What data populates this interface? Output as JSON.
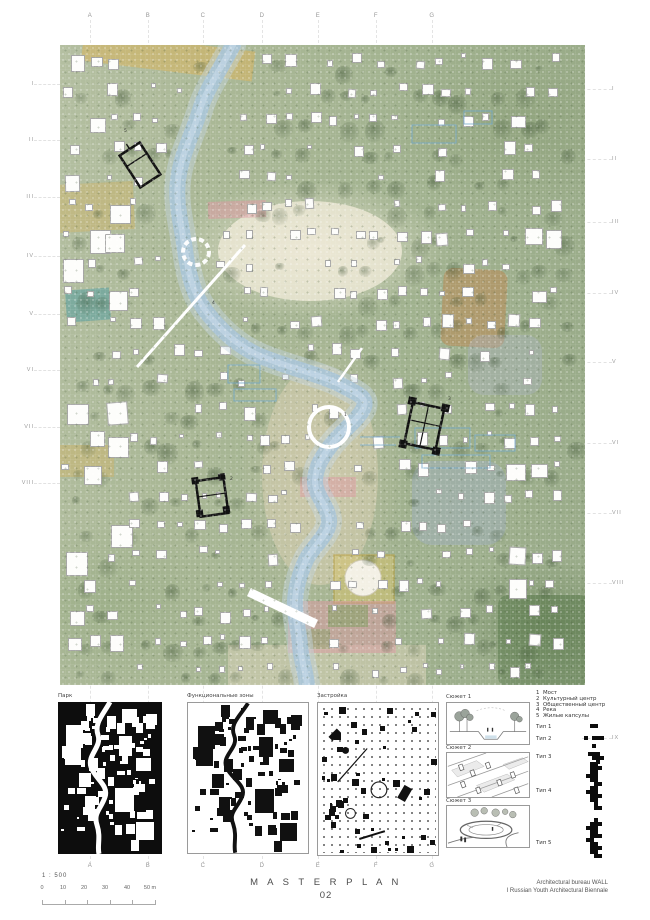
{
  "sheet": {
    "title": "M A S T E R P L A N",
    "number": "02",
    "scale_label": "1 : 500",
    "credit_line1": "Architectural bureau WALL",
    "credit_line2": "I Russian Youth Architectural Biennale"
  },
  "scalebar": {
    "ticks": [
      "0",
      "10",
      "20",
      "30",
      "40",
      "50 m"
    ],
    "xs": [
      42,
      63,
      84,
      105,
      127,
      150
    ]
  },
  "rulers": {
    "top_letters": [
      {
        "label": "A",
        "x": 90
      },
      {
        "label": "B",
        "x": 148
      },
      {
        "label": "C",
        "x": 203
      },
      {
        "label": "D",
        "x": 262
      },
      {
        "label": "E",
        "x": 318
      },
      {
        "label": "F",
        "x": 376
      },
      {
        "label": "G",
        "x": 432
      }
    ],
    "bottom_letters": [
      {
        "label": "A",
        "x": 90
      },
      {
        "label": "B",
        "x": 148
      },
      {
        "label": "C",
        "x": 203
      },
      {
        "label": "D",
        "x": 262
      },
      {
        "label": "E",
        "x": 318
      },
      {
        "label": "F",
        "x": 376
      },
      {
        "label": "G",
        "x": 432
      }
    ],
    "left_numerals": [
      {
        "label": "I",
        "y": 84
      },
      {
        "label": "II",
        "y": 140
      },
      {
        "label": "III",
        "y": 197
      },
      {
        "label": "IV",
        "y": 256
      },
      {
        "label": "V",
        "y": 314
      },
      {
        "label": "VI",
        "y": 370
      },
      {
        "label": "VII",
        "y": 427
      },
      {
        "label": "VIII",
        "y": 483
      }
    ],
    "right_numerals": [
      {
        "label": "I",
        "y": 89
      },
      {
        "label": "II",
        "y": 159
      },
      {
        "label": "III",
        "y": 222
      },
      {
        "label": "IV",
        "y": 293
      },
      {
        "label": "V",
        "y": 362
      },
      {
        "label": "VI",
        "y": 443
      },
      {
        "label": "VII",
        "y": 513
      },
      {
        "label": "VIII",
        "y": 583
      },
      {
        "label": "IX",
        "y": 738
      }
    ]
  },
  "panels": [
    {
      "label": "Парк"
    },
    {
      "label": "Функциональные зоны"
    },
    {
      "label": "Застройка"
    },
    {
      "label": "Сюжет 1"
    },
    {
      "label": "Сюжет 2"
    },
    {
      "label": "Сюжет 3"
    }
  ],
  "legend": {
    "items": [
      {
        "num": "1",
        "label": "Мост"
      },
      {
        "num": "2",
        "label": "Культурный центр"
      },
      {
        "num": "3",
        "label": "Общественный центр"
      },
      {
        "num": "4",
        "label": "Река"
      },
      {
        "num": "5",
        "label": "Жилые капсулы"
      }
    ],
    "types": [
      {
        "label": "Тип 1",
        "label_y": 724,
        "px": 590,
        "py": 724,
        "pattern": [
          "11"
        ]
      },
      {
        "label": "Тип 2",
        "label_y": 736,
        "px": 584,
        "py": 736,
        "pattern": [
          "10111"
        ]
      },
      {
        "label": "Тип 3",
        "label_y": 754,
        "px": 588,
        "py": 744,
        "pattern": [
          "0100",
          "0000",
          "1110",
          "0111",
          "0010"
        ]
      },
      {
        "label": "Тип 4",
        "label_y": 788,
        "px": 586,
        "py": 762,
        "pattern": [
          "0110",
          "0111",
          "0110",
          "1110",
          "0110",
          "0011",
          "0110",
          "1110",
          "0111",
          "0110",
          "0010",
          "0011"
        ]
      },
      {
        "label": "Тип 5",
        "label_y": 840,
        "px": 586,
        "py": 818,
        "pattern": [
          "0010",
          "0111",
          "1110",
          "0110",
          "0111",
          "1100",
          "0110",
          "0111",
          "0110",
          "0011"
        ]
      }
    ]
  },
  "map_markers": [
    {
      "num": "1",
      "x": 284,
      "y": 368
    },
    {
      "num": "2",
      "x": 170,
      "y": 432
    },
    {
      "num": "3",
      "x": 388,
      "y": 352
    },
    {
      "num": "4",
      "x": 152,
      "y": 256
    },
    {
      "num": "5",
      "x": 64,
      "y": 84
    }
  ],
  "colors": {
    "river": "#a9c4d6",
    "river-bank": "#c3d4df",
    "canal": "#6fa8cc",
    "ochre": "#d8b45c",
    "pink": "#dd9aa4",
    "orange": "#bd854e",
    "teal": "#4a9aa0",
    "garden-border": "#b89a30",
    "map-green": "#a7b591",
    "ink": "#111111"
  }
}
